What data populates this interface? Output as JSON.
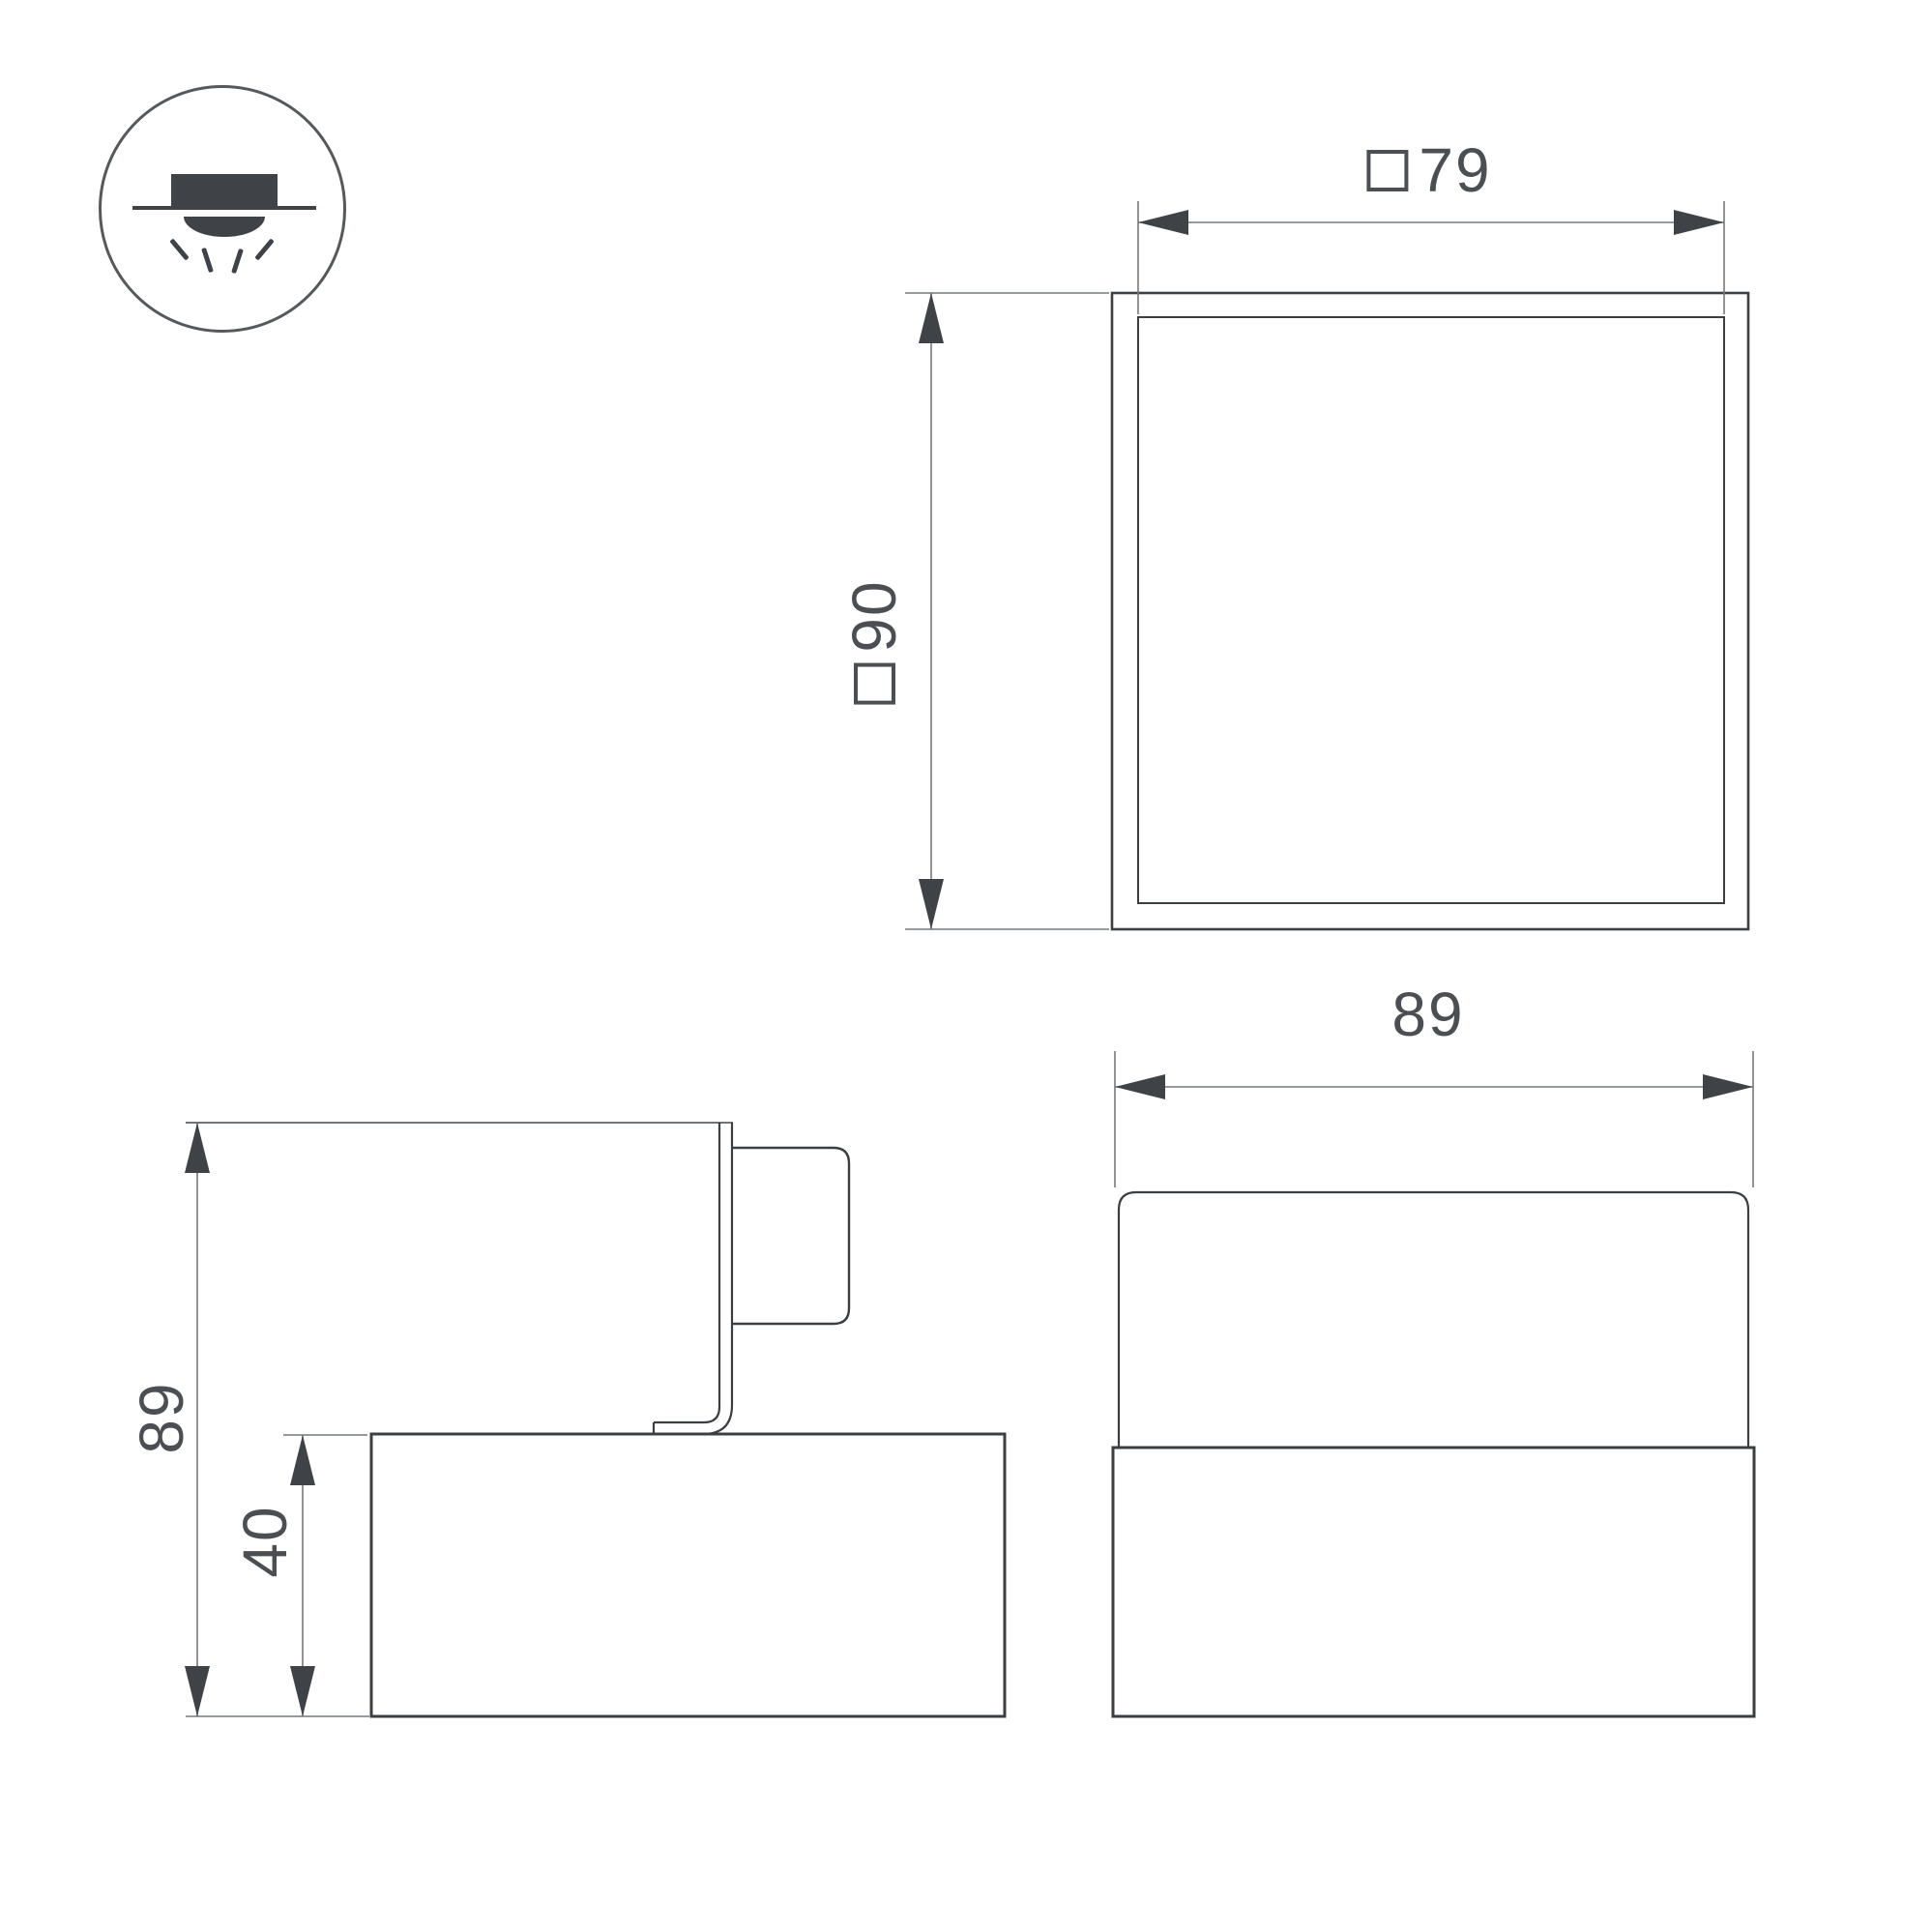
{
  "drawing": {
    "legend_icon": "surface-mounted-downlight",
    "top_view": {
      "width_dim": {
        "symbol": "□",
        "value": "79"
      },
      "height_dim": {
        "symbol": "□",
        "value": "90"
      }
    },
    "front_view": {
      "width_dim": {
        "value": "89"
      }
    },
    "side_view": {
      "height_dim": {
        "value": "89"
      },
      "base_height_dim": {
        "value": "40"
      }
    },
    "colors": {
      "outline": "#3b3f42",
      "dim_line": "#75797d",
      "arrow": "#3f4347",
      "text": "#4b4f53",
      "background": "#ffffff"
    }
  }
}
